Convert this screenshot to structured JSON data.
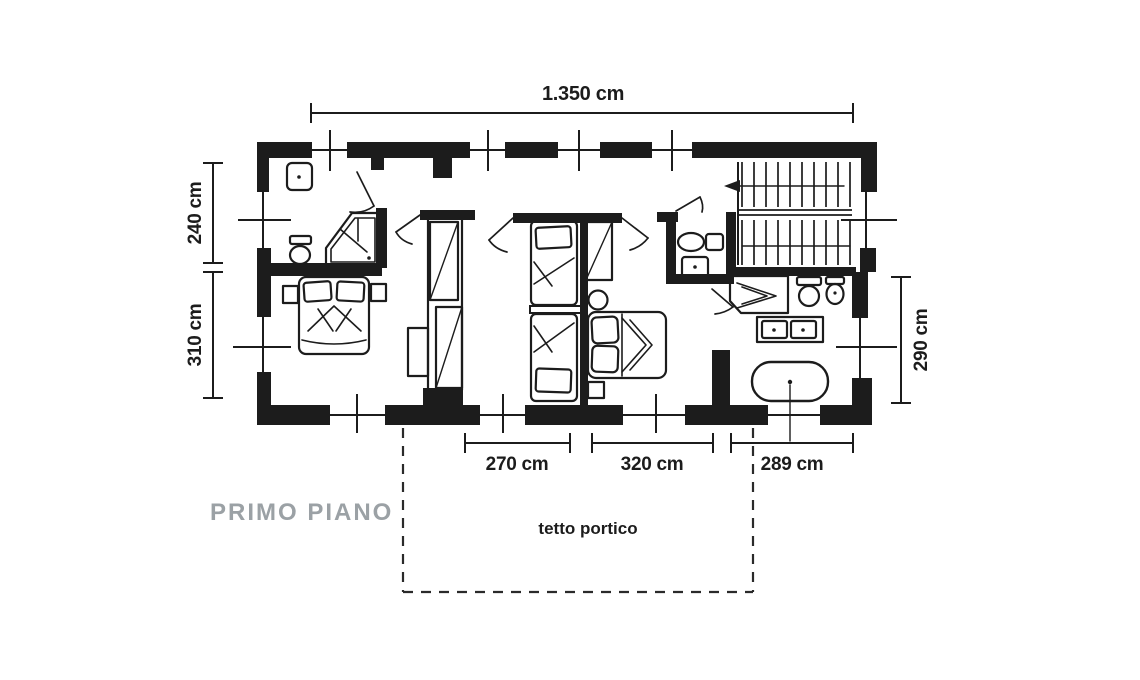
{
  "drawing": {
    "title": "PRIMO PIANO",
    "portico_label": "tetto portico",
    "dimensions": {
      "top": "1.350 cm",
      "left_upper": "240 cm",
      "left_lower": "310 cm",
      "right": "290 cm",
      "bottom_left": "270 cm",
      "bottom_center": "320 cm",
      "bottom_right": "289 cm"
    },
    "colors": {
      "ink": "#1c1c1c",
      "title_gray": "#9ba1a5",
      "background": "#ffffff"
    }
  }
}
